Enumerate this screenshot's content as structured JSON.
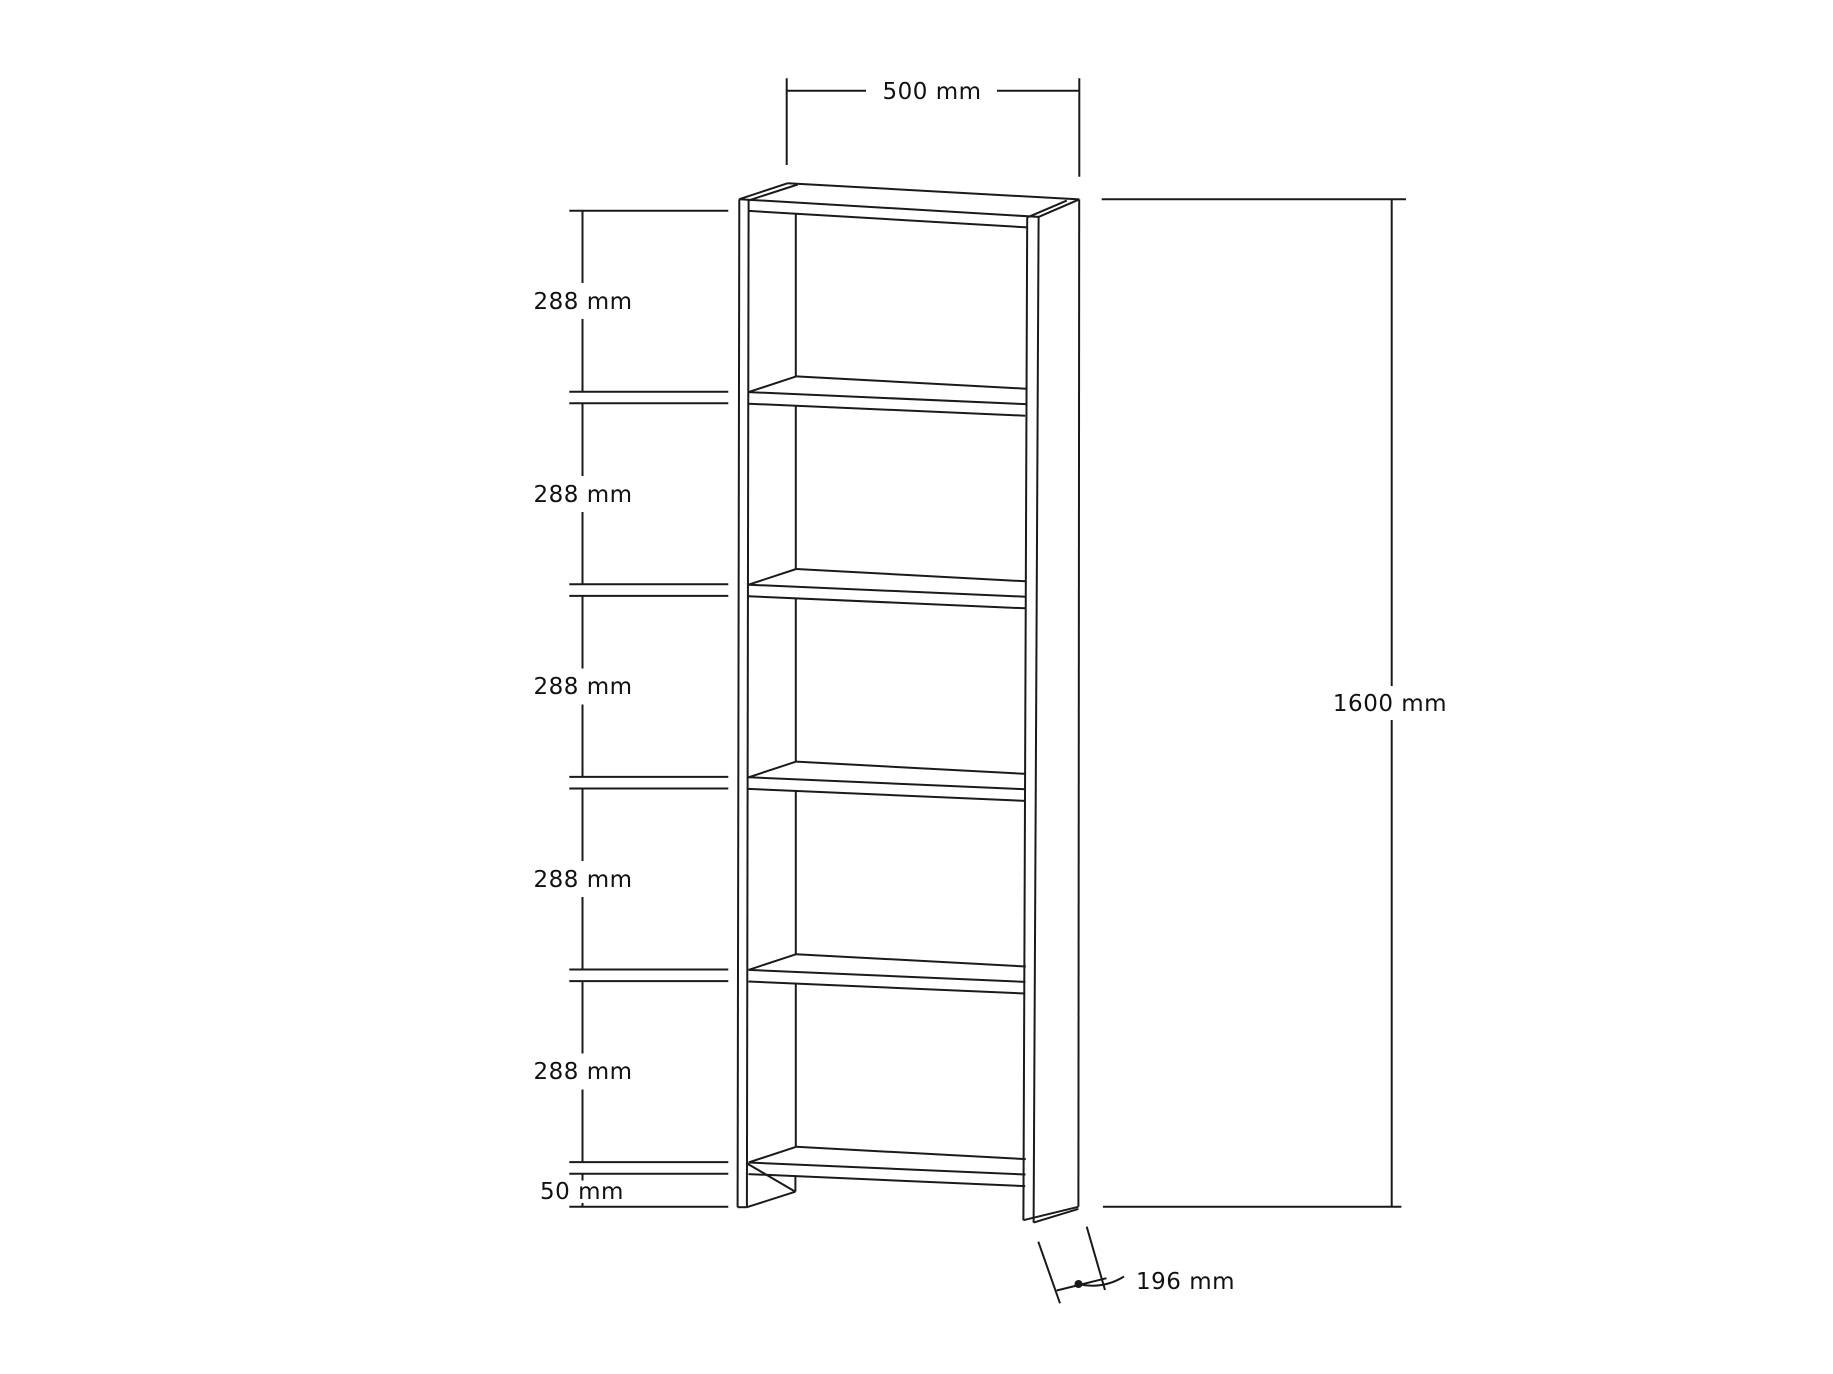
{
  "page": {
    "background_color": "#ffffff",
    "line_color": "#1a1a1a"
  },
  "drawing": {
    "type": "furniture-dimension-diagram",
    "object": "5-shelf bookcase, perspective line drawing",
    "labels": {
      "top_width": "500 mm",
      "overall_height": "1600 mm",
      "depth": "196 mm",
      "bottom_clearance": "50 mm",
      "shelf_spacings": [
        "288 mm",
        "288 mm",
        "288 mm",
        "288 mm",
        "288 mm"
      ]
    }
  }
}
